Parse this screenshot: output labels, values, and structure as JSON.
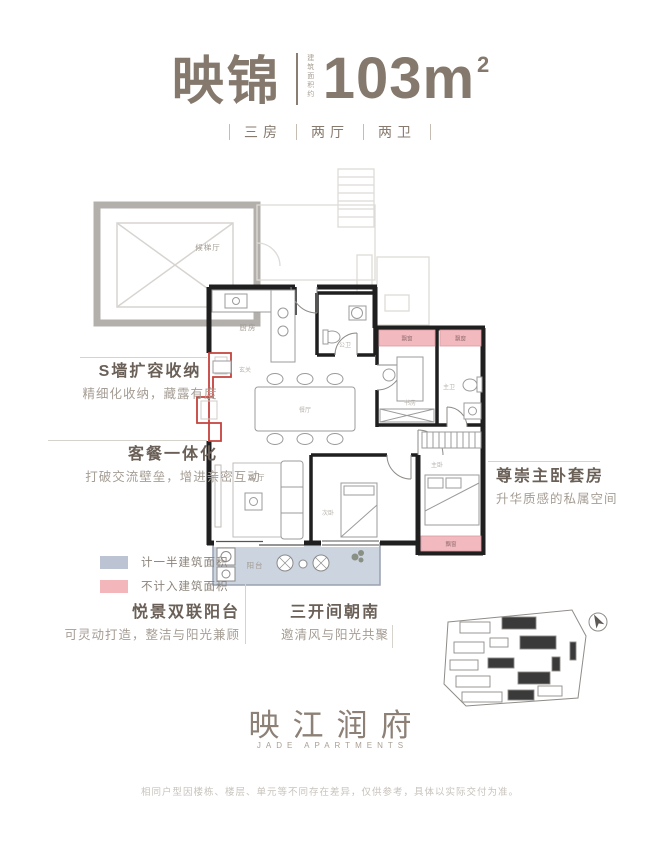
{
  "header": {
    "plan_name": "映锦",
    "area_label": "建筑面积约",
    "area_value": "103m",
    "area_sup": "2",
    "specs": [
      "三房",
      "两厅",
      "两卫"
    ]
  },
  "annotations": {
    "s_wall_title": "S墙扩容收纳",
    "s_wall_desc": "精细化收纳，藏露有度",
    "dining_title": "客餐一体化",
    "dining_desc": "打破交流壁垒，增进亲密互动",
    "master_title": "尊崇主卧套房",
    "master_desc": "升华质感的私属空间",
    "balcony_title": "悦景双联阳台",
    "balcony_desc": "可灵动打造，整洁与阳光兼顾",
    "south_title": "三开间朝南",
    "south_desc": "邀清风与阳光共聚"
  },
  "legend": {
    "half": {
      "label": "计一半建筑面积",
      "color": "#bcc4d4"
    },
    "excluded": {
      "label": "不计入建筑面积",
      "color": "#f2b6bb"
    }
  },
  "rooms": {
    "lobby": "候梯厅",
    "kitchen": "厨房",
    "entry": "玄关",
    "guest_bath": "公卫",
    "dining": "餐厅",
    "living": "客厅",
    "second_bedroom": "次卧",
    "study": "书房",
    "master_bath": "主卫",
    "master_bedroom": "主卧",
    "balcony": "阳台",
    "bay_window": "飘窗"
  },
  "footer": {
    "logo_cn": "映江润府",
    "logo_en": "JADE APARTMENTS",
    "disclaimer": "相同户型因楼栋、楼层、单元等不同存在差异，仅供参考，具体以实际交付为准。"
  },
  "colors": {
    "brand": "#85786c",
    "wall": "#1f1f1f",
    "highlight_red": "#c4423c",
    "half_area_fill": "#ccd4df",
    "excluded_fill": "#f2babe"
  }
}
